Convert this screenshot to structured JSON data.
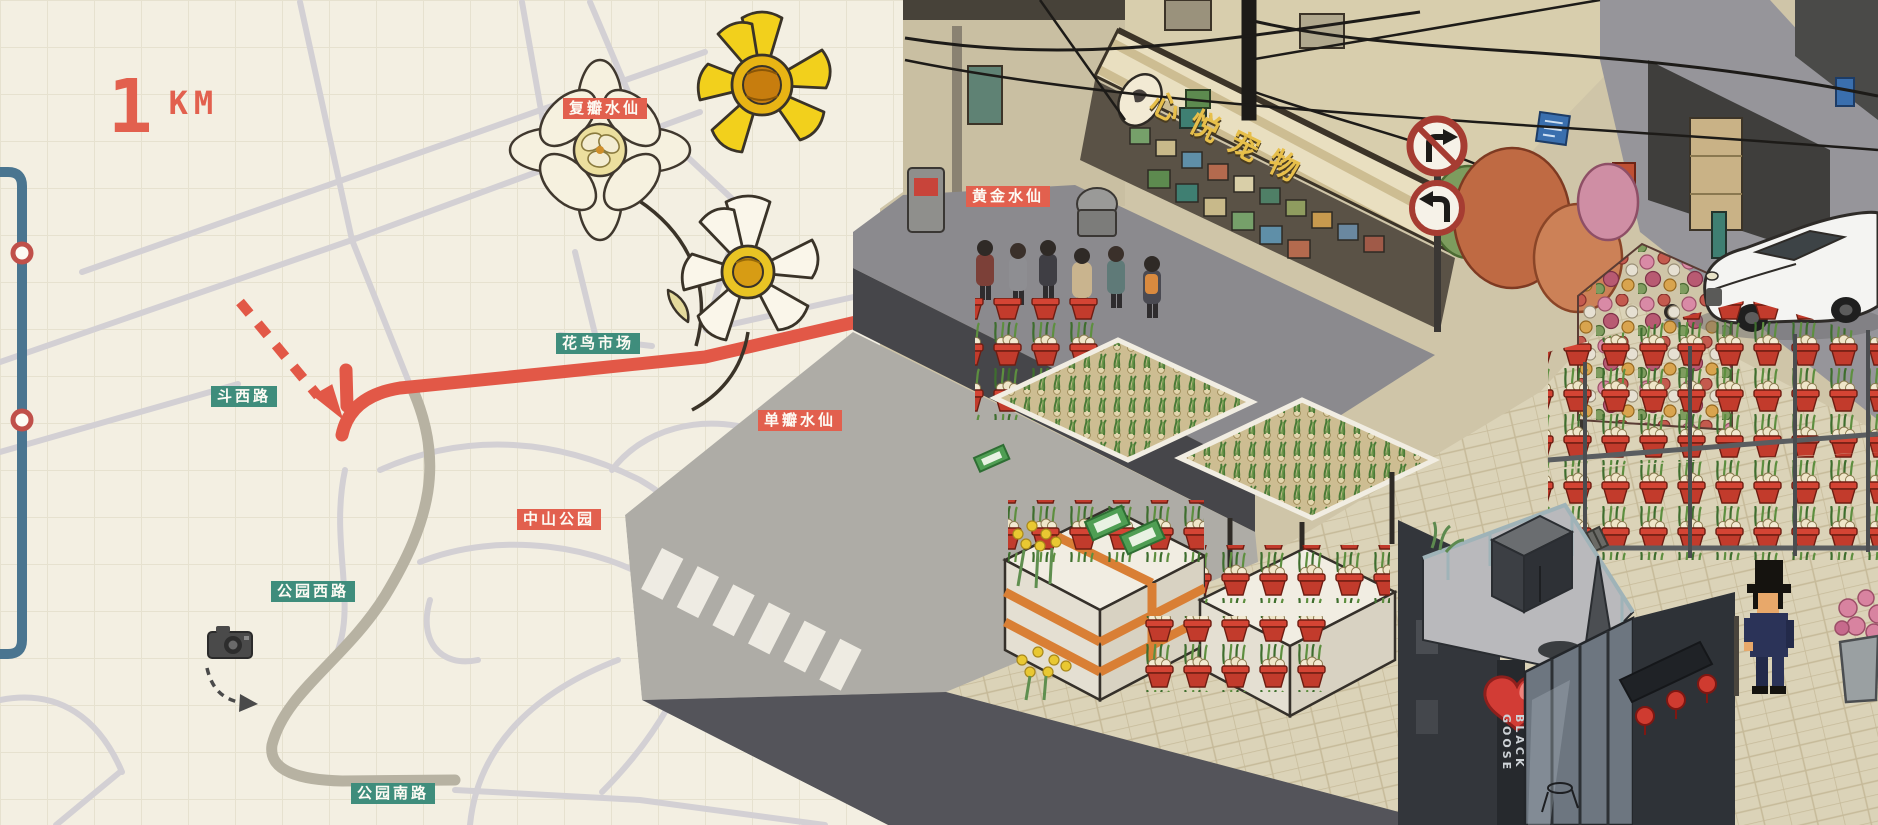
{
  "map": {
    "scale": {
      "number": "1",
      "unit": "KM"
    },
    "labels": [
      {
        "text": "斗西路",
        "style": "teal"
      },
      {
        "text": "花鸟市场",
        "style": "teal"
      },
      {
        "text": "中山公园",
        "style": "red"
      },
      {
        "text": "公园西路",
        "style": "teal"
      },
      {
        "text": "公园南路",
        "style": "teal"
      }
    ]
  },
  "flower_labels": [
    {
      "text": "复瓣水仙"
    },
    {
      "text": "黄金水仙"
    },
    {
      "text": "单瓣水仙"
    }
  ],
  "scene": {
    "pet_shop_sign": "心悦宠物",
    "cafe_sign_vertical": "BLACK GOOSE"
  },
  "icons": {
    "camera": "camera-icon",
    "metro_station": "metro-station-icon",
    "route_arrow": "route-arrow-icon",
    "no_right_turn": "no-right-turn-sign-icon",
    "left_turn": "left-turn-sign-icon",
    "heart": "heart-icon",
    "lantern": "lantern-icon",
    "player": "player-avatar"
  },
  "colors": {
    "paper": "#f3efe2",
    "grid": "#e6e1cf",
    "road": "#d3d0d4",
    "road_dark": "#b7b2a2",
    "route_red": "#e25847",
    "label_teal": "#3f8d7c",
    "label_red": "#e2604e",
    "metro_blue": "#4a7590",
    "pot_red": "#c23b2c",
    "heart_red": "#d23c35",
    "sign_yellow": "#e7bf4a"
  }
}
